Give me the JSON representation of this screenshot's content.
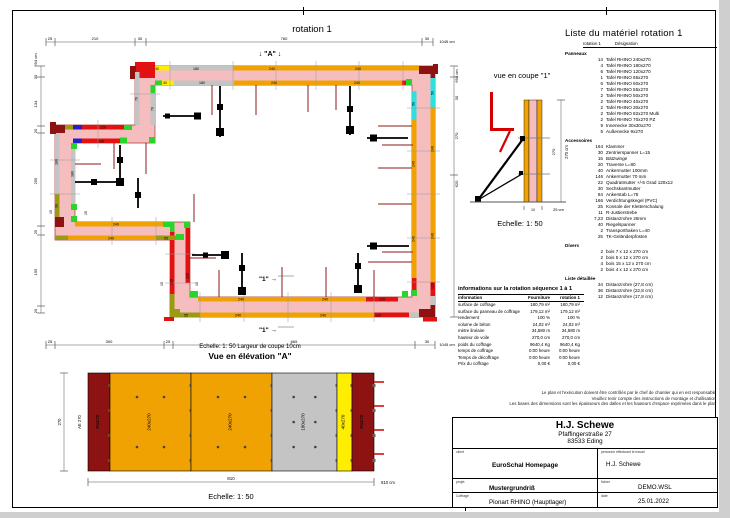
{
  "plan": {
    "title": "rotation 1",
    "marker_a": "↓ \"A\" ↓",
    "cut_marker": "\"1\" →",
    "footer": "Echelle: 1: 50  Largeur de coupe 10cm",
    "dims": {
      "top": {
        "segments": [
          "25",
          "210",
          "30",
          "760",
          "30"
        ],
        "total": "1045 cm"
      },
      "bottom": {
        "segments": [
          "25",
          "300",
          "25",
          "665",
          "30"
        ],
        "total": "1045 cm"
      },
      "left": {
        "segments": [
          "30",
          "134",
          "20",
          "255",
          "25",
          "195",
          "20"
        ],
        "total": "694 cm"
      },
      "right": {
        "segments": [
          "30",
          "270",
          "620"
        ],
        "total": "694 cm"
      }
    },
    "labels": [
      {
        "t": "rotation 1",
        "x": 296,
        "y": 18,
        "r": 0,
        "s": 9.5
      },
      {
        "t": "↓ \"A\" ↓",
        "x": 254,
        "y": 42,
        "r": 0,
        "s": 7,
        "b": 1
      },
      {
        "t": "\"1\" →",
        "x": 252,
        "y": 267,
        "r": 0,
        "s": 6.5,
        "b": 1
      },
      {
        "t": "\"1\" →",
        "x": 252,
        "y": 318,
        "r": 0,
        "s": 6.5,
        "b": 1
      },
      {
        "t": "25",
        "x": 34,
        "y": 26,
        "r": 0,
        "s": 4
      },
      {
        "t": "210",
        "x": 79,
        "y": 26,
        "r": 0,
        "s": 4
      },
      {
        "t": "30",
        "x": 124,
        "y": 26,
        "r": 0,
        "s": 4
      },
      {
        "t": "760",
        "x": 268,
        "y": 26,
        "r": 0,
        "s": 4
      },
      {
        "t": "30",
        "x": 411,
        "y": 26,
        "r": 0,
        "s": 4
      },
      {
        "t": "1045 cm",
        "x": 431,
        "y": 29,
        "r": 0,
        "s": 4
      },
      {
        "t": "25",
        "x": 34,
        "y": 329,
        "r": 0,
        "s": 4
      },
      {
        "t": "300",
        "x": 93,
        "y": 329,
        "r": 0,
        "s": 4
      },
      {
        "t": "25",
        "x": 152,
        "y": 329,
        "r": 0,
        "s": 4
      },
      {
        "t": "665",
        "x": 278,
        "y": 329,
        "r": 0,
        "s": 4
      },
      {
        "t": "30",
        "x": 411,
        "y": 329,
        "r": 0,
        "s": 4
      },
      {
        "t": "1045 cm",
        "x": 431,
        "y": 332,
        "r": 0,
        "s": 4
      },
      {
        "t": "694 cm",
        "x": 21,
        "y": 46,
        "r": -90,
        "s": 4
      },
      {
        "t": "30",
        "x": 21,
        "y": 63,
        "r": -90,
        "s": 4
      },
      {
        "t": "134",
        "x": 21,
        "y": 90,
        "r": -90,
        "s": 4
      },
      {
        "t": "20",
        "x": 21,
        "y": 117,
        "r": -90,
        "s": 4
      },
      {
        "t": "255",
        "x": 21,
        "y": 167,
        "r": -90,
        "s": 4
      },
      {
        "t": "25",
        "x": 21,
        "y": 218,
        "r": -90,
        "s": 4
      },
      {
        "t": "195",
        "x": 21,
        "y": 258,
        "r": -90,
        "s": 4
      },
      {
        "t": "20",
        "x": 21,
        "y": 297,
        "r": -90,
        "s": 4
      },
      {
        "t": "694 cm",
        "x": 442,
        "y": 62,
        "r": -90,
        "s": 4
      },
      {
        "t": "30",
        "x": 442,
        "y": 84,
        "r": -90,
        "s": 4
      },
      {
        "t": "270",
        "x": 442,
        "y": 122,
        "r": -90,
        "s": 4
      },
      {
        "t": "620",
        "x": 442,
        "y": 170,
        "r": -90,
        "s": 4
      },
      {
        "t": "40",
        "x": 141,
        "y": 55.8,
        "r": 0,
        "s": 3.6
      },
      {
        "t": "180",
        "x": 180,
        "y": 55.8,
        "r": 0,
        "s": 3.6
      },
      {
        "t": "240",
        "x": 256,
        "y": 55.8,
        "r": 0,
        "s": 3.6
      },
      {
        "t": "240",
        "x": 342,
        "y": 55.8,
        "r": 0,
        "s": 3.6
      },
      {
        "t": "40",
        "x": 149,
        "y": 70.2,
        "r": 0,
        "s": 3.6
      },
      {
        "t": "180",
        "x": 186,
        "y": 70.2,
        "r": 0,
        "s": 3.6
      },
      {
        "t": "240",
        "x": 258,
        "y": 70.2,
        "r": 0,
        "s": 3.6
      },
      {
        "t": "240",
        "x": 341,
        "y": 70.2,
        "r": 0,
        "s": 3.6
      },
      {
        "t": "55",
        "x": 170,
        "y": 302.4,
        "r": 0,
        "s": 3.6
      },
      {
        "t": "240",
        "x": 222,
        "y": 302.4,
        "r": 0,
        "s": 3.6
      },
      {
        "t": "240",
        "x": 307,
        "y": 302.4,
        "r": 0,
        "s": 3.6
      },
      {
        "t": "120",
        "x": 362,
        "y": 302.4,
        "r": 0,
        "s": 3.6
      },
      {
        "t": "240",
        "x": 225,
        "y": 286.6,
        "r": 0,
        "s": 3.6
      },
      {
        "t": "240",
        "x": 309,
        "y": 286.6,
        "r": 0,
        "s": 3.6
      },
      {
        "t": "120",
        "x": 366,
        "y": 286.6,
        "r": 0,
        "s": 3.6
      },
      {
        "t": "240",
        "x": 95,
        "y": 225.4,
        "r": 0,
        "s": 3.6
      },
      {
        "t": "55",
        "x": 150,
        "y": 225.4,
        "r": 0,
        "s": 3.6
      },
      {
        "t": "240",
        "x": 100,
        "y": 211.6,
        "r": 0,
        "s": 3.6
      },
      {
        "t": "180",
        "x": 41.5,
        "y": 148,
        "r": -90,
        "s": 3.6
      },
      {
        "t": "30",
        "x": 41.5,
        "y": 192,
        "r": -90,
        "s": 3.6
      },
      {
        "t": "180",
        "x": 57.5,
        "y": 160,
        "r": -90,
        "s": 3.6
      },
      {
        "t": "120",
        "x": 156.5,
        "y": 268,
        "r": -90,
        "s": 3.6
      },
      {
        "t": "120",
        "x": 172.5,
        "y": 262,
        "r": -90,
        "s": 3.6
      },
      {
        "t": "120",
        "x": 87,
        "y": 114.4,
        "r": 0,
        "s": 3.6
      },
      {
        "t": "120",
        "x": 85,
        "y": 128.4,
        "r": 0,
        "s": 3.6
      },
      {
        "t": "70",
        "x": 121.5,
        "y": 85,
        "r": -90,
        "s": 3.6
      },
      {
        "t": "70",
        "x": 137.5,
        "y": 95,
        "r": -90,
        "s": 3.6
      },
      {
        "t": "50",
        "x": 417.5,
        "y": 79,
        "r": -90,
        "s": 3.6
      },
      {
        "t": "240",
        "x": 417.5,
        "y": 135,
        "r": -90,
        "s": 3.6
      },
      {
        "t": "240",
        "x": 417.5,
        "y": 222,
        "r": -90,
        "s": 3.6
      },
      {
        "t": "120",
        "x": 417.5,
        "y": 272,
        "r": -90,
        "s": 3.6
      },
      {
        "t": "50",
        "x": 398.5,
        "y": 90,
        "r": -90,
        "s": 3.6
      },
      {
        "t": "240",
        "x": 398.5,
        "y": 150,
        "r": -90,
        "s": 3.6
      },
      {
        "t": "240",
        "x": 398.5,
        "y": 225,
        "r": -90,
        "s": 3.6
      },
      {
        "t": "15",
        "x": 36,
        "y": 198,
        "r": -90,
        "s": 3.6
      },
      {
        "t": "15",
        "x": 71,
        "y": 199,
        "r": -90,
        "s": 3.6
      },
      {
        "t": "15",
        "x": 147,
        "y": 270,
        "r": -90,
        "s": 3.6
      },
      {
        "t": "15",
        "x": 182,
        "y": 270,
        "r": -90,
        "s": 3.6
      }
    ]
  },
  "coupe": {
    "title": "vue en coupe \"1\"",
    "scale": "Echelle: 1: 50",
    "dim_right": "270 cm",
    "dim_inner": "270",
    "dim_core": "10",
    "dim_bottom": "25 cm"
  },
  "elevation": {
    "title": "Vue en élévation \"A\"",
    "scale": "Echelle: 1: 50",
    "corner_label": "AE 270",
    "dim_left": "270",
    "dim_bottom": "810",
    "dim_total": "810 cm",
    "panels": [
      {
        "label": "70x270",
        "color": "#8d1212",
        "w": 22
      },
      {
        "label": "240x270",
        "color": "#f0a202",
        "w": 81
      },
      {
        "label": "240x270",
        "color": "#f0a202",
        "w": 81
      },
      {
        "label": "180x270",
        "color": "#c4c4c4",
        "w": 65
      },
      {
        "label": "40x270",
        "color": "#ffee00",
        "w": 15
      },
      {
        "label": "70x270",
        "color": "#8d1212",
        "w": 22
      }
    ]
  },
  "material_list": {
    "title": "Liste du matériel  rotation 1",
    "col1": "rotation 1",
    "col2": "Désignation",
    "sections": [
      {
        "name": "Panneaux",
        "items": [
          [
            "14",
            "Tafel RHINO 240x270"
          ],
          [
            "4",
            "Tafel RHINO 180x270"
          ],
          [
            "6",
            "Tafel RHINO 120x270"
          ],
          [
            "1",
            "Tafel RHINO 65x270"
          ],
          [
            "6",
            "Tafel RHINO 60x270"
          ],
          [
            "7",
            "Tafel RHINO 55x270"
          ],
          [
            "2",
            "Tafel RHINO 50x270"
          ],
          [
            "2",
            "Tafel RHINO 40x270"
          ],
          [
            "2",
            "Tafel RHINO 30x270"
          ],
          [
            "2",
            "Tafel RHINO 82x270 Multi"
          ],
          [
            "2",
            "Tafel RHINO 70x270 PZ"
          ],
          [
            "9",
            "Innenecke 30x30x270"
          ],
          [
            "5",
            "Außenecke 9x270"
          ]
        ]
      },
      {
        "name": "Accessoires",
        "items": [
          [
            "164",
            "Klammer"
          ],
          [
            "30",
            "Zentrierspanner L=15"
          ],
          [
            "15",
            "Bätzwinge"
          ],
          [
            "20",
            "Traverse L=80"
          ],
          [
            "40",
            "Ankermutter 100mm"
          ],
          [
            "146",
            "Ankermutter 70 mm"
          ],
          [
            "22",
            "Quadratmutter +/-5 Grad 120x12"
          ],
          [
            "30",
            "Sechskantmutter"
          ],
          [
            "84",
            "Ankerstab L=75"
          ],
          [
            "166",
            "Verdichtungskegel (PVC)"
          ],
          [
            "25",
            "Konsole der Kletterschalung"
          ],
          [
            "11",
            "R-Justierstrebe"
          ],
          [
            "7,23",
            "Distanzrohre 26mm"
          ],
          [
            "40",
            "Riegelspanner"
          ],
          [
            "2",
            "Transporthaken L=40"
          ],
          [
            "25",
            "TK-Geländerpfosten"
          ]
        ]
      },
      {
        "name": "Divers",
        "items": [
          [
            "2",
            "bois 7 x 12 x 270 cm"
          ],
          [
            "2",
            "bois 5 x 12 x 270 cm"
          ],
          [
            "4",
            "bois 15 x 12 x 270 cm"
          ],
          [
            "2",
            "bois 4 x 12 x 270 cm"
          ]
        ]
      },
      {
        "name": "Liste détaillée",
        "items": [
          [
            "34",
            "Distanzrohre  (27,8 cm)"
          ],
          [
            "36",
            "Distanzrohre  (22,8 cm)"
          ],
          [
            "12",
            "Distanzrohre  (17,8 cm)"
          ]
        ]
      }
    ]
  },
  "info_table": {
    "title": "informations sur la rotation  séquence 1 à 1",
    "headers": [
      "information",
      "Fourniture",
      "rotation 1"
    ],
    "rows": [
      [
        "surface de coffrage",
        "180,79 m²",
        "180,79 m²"
      ],
      [
        "surface du panneau de coffrage",
        "179,12 m²",
        "179,12 m²"
      ],
      [
        "rendement",
        "100 %",
        "100 %"
      ],
      [
        "volume de béton",
        "24,02 m³",
        "24,02 m³"
      ],
      [
        "mètre linéaire",
        "34,580 m",
        "34,580 m"
      ],
      [
        "hauteur de voile",
        "270,0 cm",
        "270,0 cm"
      ],
      [
        "poids du coffrage",
        "9640,4 Kg",
        "9640,4 Kg"
      ],
      [
        "temps de coffrage",
        "0:00 heure",
        "0:00 heure"
      ],
      [
        "Temps de décoffrage",
        "0:00 heure",
        "0:00 heure"
      ],
      [
        "Prix du coffrage",
        "0,00 €",
        "0,00 €"
      ]
    ]
  },
  "disclaimer": [
    "Le plan et l'exécution doivent être contrôlés par le chef de chantier qui en est responsable",
    "Veuillez tenir compte des instructions de montage et d'utilisation",
    "Les bases des dimensions sont les épaisseurs des dalles et les hauteurs d'espace exprimées dans le plan"
  ],
  "title_block": {
    "company": "H.J. Schewe",
    "street": "Pfaffingerstraße 27",
    "city": "83533 Eding",
    "client_label": "client",
    "client": "EuroSchal Homepage",
    "worker_label": "personne effectuant le travail",
    "worker": "H.J. Schewe",
    "project_label": "projet",
    "project": "Mustergrundriß",
    "file_label": "fichier",
    "file": "DEMO.WSL",
    "formwork_label": "Coffrage",
    "formwork": "Pionart RHINO (Hauptlager)",
    "date_label": "date",
    "date": "25.01.2022"
  },
  "colors": {
    "wall_core": "#f5bdbd",
    "panel_240": "#f0a202",
    "panel_180": "#c4c4c4",
    "panel_40": "#ffee00",
    "panel_120": "#e31212",
    "panel_pz": "#8d1212",
    "corner_green": "#2ad42a",
    "corner_cyan": "#2ee0e0",
    "corner_olive": "#9b9b13",
    "corner_blue": "#2222cc",
    "tie_red": "#8b1a1a"
  }
}
